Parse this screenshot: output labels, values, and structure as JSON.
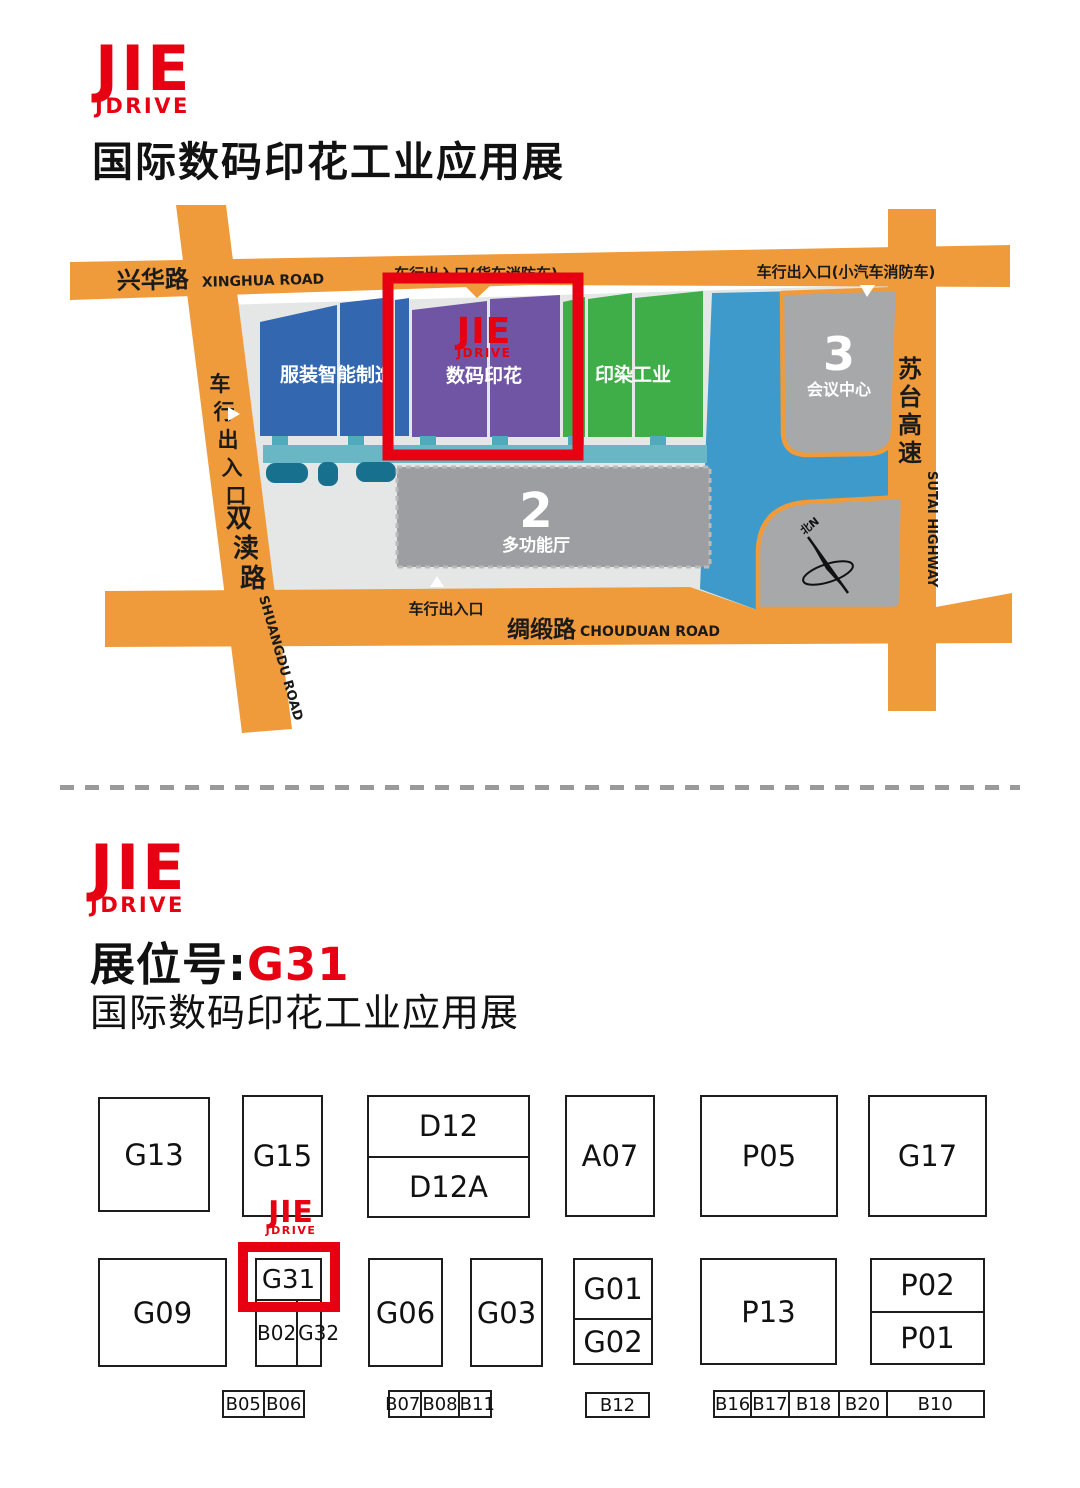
{
  "logo": {
    "top": "JIE",
    "bottom": "JDRIVE"
  },
  "header": {
    "title": "国际数码印花工业应用展"
  },
  "map": {
    "roads": {
      "xinghua_zh": "兴华路",
      "xinghua_en": "XINGHUA ROAD",
      "shuangdu_zh": "双渎路",
      "shuangdu_en": "SHUANGDU ROAD",
      "chouduan_zh": "绸缎路",
      "chouduan_en": "CHOUDUAN ROAD",
      "sutai_zh": "苏台高速",
      "sutai_en": "SUTAI HIGHWAY"
    },
    "entrances": {
      "west_gate": "车行出入口",
      "north_truck_gate": "车行出入口(货车消防车)",
      "north_car_gate": "车行出入口(小汽车消防车)",
      "south_gate": "车行出入口"
    },
    "halls": {
      "garment": "服装智能制造",
      "digital_printing": "数码印花",
      "dyeing": "印染工业",
      "hall2_no": "2",
      "hall2_name": "多功能厅",
      "hall3_no": "3",
      "hall3_name": "会议中心"
    },
    "compass_north": "北N"
  },
  "booth_section": {
    "label": "展位号:",
    "number": "G31",
    "subtitle": "国际数码印花工业应用展"
  },
  "booths": {
    "g13": "G13",
    "g15": "G15",
    "d12": "D12",
    "d12a": "D12A",
    "a07": "A07",
    "p05": "P05",
    "g17": "G17",
    "g09": "G09",
    "g31": "G31",
    "b02": "B02",
    "g32": "G32",
    "g06": "G06",
    "g03": "G03",
    "g01": "G01",
    "g02": "G02",
    "p13": "P13",
    "p02": "P02",
    "p01": "P01",
    "b05": "B05",
    "b06": "B06",
    "b07": "B07",
    "b08": "B08",
    "b11": "B11",
    "b12": "B12",
    "b16": "B16",
    "b17": "B17",
    "b18": "B18",
    "b20": "B20",
    "b10": "B10"
  },
  "colors": {
    "brand_red": "#E60012",
    "road_orange": "#F09B3B",
    "hall_blue": "#3368B1",
    "hall_purple": "#6F55A4",
    "hall_green": "#3FAE49",
    "water_blue": "#3E9ACB",
    "teal_bar": "#69B7C4",
    "teal_dark": "#18708F",
    "venue_gray": "#E4E7E6",
    "building_gray": "#A6A8AA"
  }
}
